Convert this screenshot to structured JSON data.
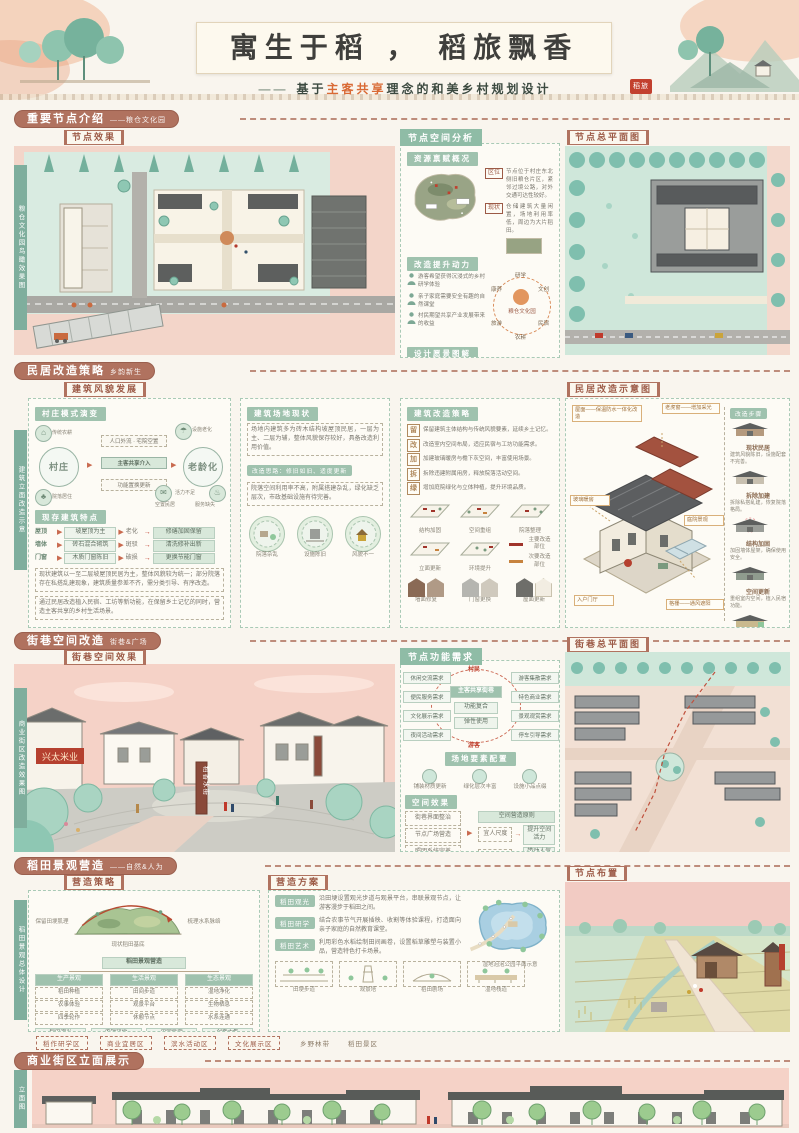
{
  "icons": {
    "house": "⌂",
    "umbrella": "☂",
    "spring": "♨",
    "club": "♣",
    "mail": "✉",
    "arrow": "▶",
    "arrow2": "→"
  },
  "banner": {
    "title": "寓生于稻 ， 稻旅飘香",
    "dash": "——",
    "subtitle_pre": "基于",
    "subtitle_hl": "主客共享",
    "subtitle_post": "理念的和美乡村规划设计",
    "seal": "稻旅"
  },
  "s1": {
    "header": "重要节点介绍",
    "header_suffix": "——粮仓文化园",
    "effect_label": "节点效果",
    "vtab": "粮仓文化园鸟瞰效果图",
    "mid_title": "节点空间分析",
    "sub_resource": "资源禀赋概况",
    "notes": [
      {
        "tag": "区位",
        "text": "节点位于村庄东北侧旧粮仓片区，紧邻过境公路，对外交通可达性较好。"
      },
      {
        "tag": "现状",
        "text": "仓储建筑大量闲置，场地利用率低，周边为大片稻田。"
      }
    ],
    "sub_power": "改造提升动力",
    "radial": {
      "center": "粮仓文化园",
      "items": [
        "研学",
        "文创",
        "民宿",
        "农耕",
        "旅游",
        "康养"
      ]
    },
    "motives": [
      "游客希望获得沉浸式的乡村研学体验",
      "亲子家庭需要安全有趣的自然课堂",
      "村民期望共享产业发展带来的收益"
    ],
    "sub_vision": "设计愿景图解",
    "sketch_caps": [
      "现状肌理",
      "规划结构"
    ],
    "vision_icons": [
      "①",
      "②",
      "③",
      "④",
      "⑤"
    ],
    "visions": [
      "保留场地原有肌理与粮仓风貌特色",
      "打造一轴两片多节点的空间结构",
      "植入研学展示与农事体验功能",
      "完善基础设施与旅游服务配套",
      "营造面向稻田的景观观赏界面"
    ],
    "right_title": "节点总平面图"
  },
  "s2": {
    "header": "民居改造策略",
    "header_suffix": "乡韵新生",
    "facade_label": "建筑风貌发展",
    "vtab": "建筑立面改造示意",
    "col1_title": "村庄模式演变",
    "circle_left": "村庄",
    "circle_right": "老龄化",
    "left_sats": [
      "传统农耕",
      "院落居住"
    ],
    "right_sats": [
      "设施老化",
      "活力不足",
      "空置民居",
      "服务缺失"
    ],
    "bridge_top": "人口外流 · 宅院空置",
    "bridge_mid": "主客共享介入",
    "bridge_bottom": "功能置换更新",
    "col1_sub": "现存建筑特点",
    "flows": [
      {
        "a": "屋顶",
        "b": "坡屋顶为主",
        "c": "老化",
        "d": "修缮加固保留"
      },
      {
        "a": "墙体",
        "b": "砖石混合砌筑",
        "c": "斑驳",
        "d": "清洗修补出新"
      },
      {
        "a": "门窗",
        "b": "木质门窗陈旧",
        "c": "破损",
        "d": "更换节能门窗"
      }
    ],
    "paras": [
      "现状建筑以一至二层坡屋顶民居为主，整体风貌较为统一；部分院落存在私搭乱建现象，建筑质量参差不齐，需分类引导、有序改造。",
      "通过民居改造植入民宿、工坊等新功能，在保留乡土记忆的同时，营造主客共享的乡村生活场景。"
    ],
    "col2_title": "建筑场地现状",
    "col2_paras": [
      "场地内建筑多为砖木结构坡屋顶民居，一层为主、二层为辅，整体风貌保存较好，具备改造利用价值。",
      "院落空间利用率不高，附属搭建杂乱，绿化缺乏层次，市政基础设施有待完善。"
    ],
    "col2_tag": "改造思路：修旧如旧、适度更新",
    "col2_caps": [
      "院落杂乱",
      "设施陈旧",
      "风貌不一"
    ],
    "col3_title": "建筑改造策略",
    "strategies": [
      {
        "n": "留",
        "t": "保留建筑主体结构与传统风貌要素，延续乡土记忆。"
      },
      {
        "n": "改",
        "t": "改造室内空间布局，适应民宿与工坊功能需求。"
      },
      {
        "n": "加",
        "t": "加建玻璃暖房与檐下灰空间，丰富使用场景。"
      },
      {
        "n": "拆",
        "t": "拆除违建附属用房，释放院落活动空间。"
      },
      {
        "n": "绿",
        "t": "增加庭院绿化与立体种植，提升环境品质。"
      }
    ],
    "axon_caps": [
      "结构加固",
      "空间重组",
      "院落整理",
      "立面更新",
      "环境提升"
    ],
    "legend": [
      "主要改造部位",
      "次要改造部位"
    ],
    "facade_caps": [
      "墙面修复",
      "门窗更换",
      "屋面更新"
    ],
    "col4_title": "民居改造示意图",
    "callouts": [
      "屋面——保温防水一体化改造",
      "老虎窗——增加采光",
      "玻璃暖房",
      "庭院景观",
      "入户门厅",
      "格栅——通风遮阳"
    ],
    "steps_head": "改造步骤",
    "steps": [
      {
        "cap": "现状民居",
        "t": "建筑风貌陈旧，设施配套不完善。"
      },
      {
        "cap": "拆除加建",
        "t": "拆除私搭乱建，恢复院落格局。"
      },
      {
        "cap": "结构加固",
        "t": "加固墙体屋架，确保使用安全。"
      },
      {
        "cap": "空间更新",
        "t": "重组室内空间，植入民宿功能。"
      },
      {
        "cap": "品质提升",
        "t": "完善设施配套，提升庭院环境。"
      }
    ]
  },
  "s3": {
    "header": "街巷空间改造",
    "header_suffix": "街巷&广场",
    "effect_label": "街巷空间效果",
    "vtab": "商业街区改造效果图",
    "sign_text": "兴太米业",
    "monument_text": "稻香水街",
    "mid_title1": "节点功能需求",
    "radial_top": "村民",
    "radial_bottom": "游客",
    "left_needs": [
      "休闲交流需求",
      "便民服务需求",
      "文化展示需求",
      "夜间活动需求"
    ],
    "right_needs": [
      "游客集散需求",
      "特色商业需求",
      "景观观赏需求",
      "停车引导需求"
    ],
    "center_items": [
      "主客共享街巷",
      "功能复合",
      "弹性使用"
    ],
    "center_tag": "场地要素配置",
    "element_caps": [
      "铺装材质更新",
      "绿化层次丰富",
      "设施小品点缀"
    ],
    "mid_title2": "空间效果",
    "flow_left": [
      "街巷界面整治",
      "节点广场营造",
      "照明系统完善",
      "标识系统设计"
    ],
    "flow_head": "空间营造原则",
    "flow_rows": [
      {
        "a": "宜人尺度",
        "b": "提升空间活力"
      },
      {
        "a": "复合业态",
        "b": "带动人气集聚"
      },
      {
        "a": "夜间照明",
        "b": "延长活动时间"
      }
    ],
    "scene_caps": [
      "入口广场",
      "休闲街巷",
      "滨水步道"
    ],
    "right_title": "街巷总平面图"
  },
  "s4": {
    "header": "稻田景观营造",
    "header_suffix": "——自然&人为",
    "strategy_label": "营造策略",
    "plan_label": "营造方案",
    "layout_label": "节点布置",
    "vtab": "稻田景观总体设计",
    "hill_left": "保留田埂肌理",
    "hill_right": "梳理水系脉络",
    "hill_cap": "现状稻田基底",
    "tree_root": "稻田景观营造",
    "branches": [
      {
        "name": "生产景观",
        "kids": [
          "稻田种植",
          "农事体验",
          "四季轮作"
        ]
      },
      {
        "name": "生活景观",
        "kids": [
          "田间步道",
          "观景平台",
          "休憩节点"
        ]
      },
      {
        "name": "生态景观",
        "kids": [
          "湿地净化",
          "生物栖息",
          "水系连通"
        ]
      }
    ],
    "leaf_rows": [
      [
        "稻田观光",
        "农耕研学",
        "田园民宿",
        "创意市集"
      ],
      [
        "湿地科普",
        "亲子活动",
        "摄影写生",
        "节庆活动"
      ]
    ],
    "plans": [
      {
        "tag": "稻田观光",
        "t": "沿田埂设置观光步道与观景平台，串联景观节点，让游客漫步于稻田之间。"
      },
      {
        "tag": "稻田研学",
        "t": "结合农事节气开展插秧、收割等体验课程，打造面向亲子家庭的自然教育课堂。"
      },
      {
        "tag": "稻田艺术",
        "t": "利用彩色水稻绘制田间画卷，设置稻草雕塑与装置小品，营造特色打卡场景。"
      }
    ],
    "pond_cap": "湿地泡泡公园平面示意",
    "sketch_caps": [
      "田埂步道",
      "观景塔",
      "稻田剧场",
      "湿地栈道"
    ],
    "zone_tags": [
      "稻作研学区",
      "商业宜居区",
      "滨水活动区",
      "文化展示区"
    ],
    "plain_tags": [
      "乡野林带",
      "稻田景区"
    ]
  },
  "s5": {
    "header": "商业街区立面展示",
    "vtab": "立面图"
  }
}
